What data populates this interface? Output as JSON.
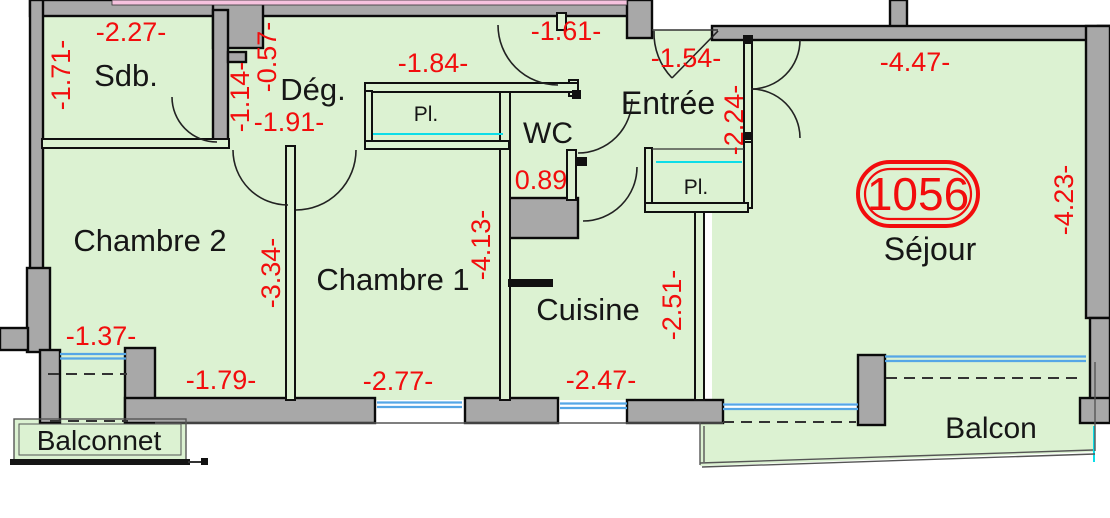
{
  "plan": {
    "unit_number": "1056",
    "rooms": [
      {
        "id": "sdb",
        "label": "Sdb."
      },
      {
        "id": "degagement",
        "label": "Dég."
      },
      {
        "id": "entree",
        "label": "Entrée"
      },
      {
        "id": "wc",
        "label": "WC"
      },
      {
        "id": "chambre2",
        "label": "Chambre 2"
      },
      {
        "id": "chambre1",
        "label": "Chambre 1"
      },
      {
        "id": "cuisine",
        "label": "Cuisine"
      },
      {
        "id": "sejour",
        "label": "Séjour"
      },
      {
        "id": "balcon",
        "label": "Balcon"
      },
      {
        "id": "balconnet",
        "label": "Balconnet"
      }
    ],
    "closets": [
      {
        "label": "Pl."
      },
      {
        "label": "Pl."
      }
    ],
    "dims_h": [
      {
        "label": "-2.27-"
      },
      {
        "label": "-1.84-"
      },
      {
        "label": "-1.61-"
      },
      {
        "label": "-1.54-"
      },
      {
        "label": "-4.47-"
      },
      {
        "label": "-1.91-"
      },
      {
        "label": "0.89"
      },
      {
        "label": "-1.37-"
      },
      {
        "label": "-1.79-"
      },
      {
        "label": "-2.77-"
      },
      {
        "label": "-2.47-"
      }
    ],
    "dims_v": [
      {
        "label": "-1.71-"
      },
      {
        "label": "-0.57-"
      },
      {
        "label": "-1.14-"
      },
      {
        "label": "-2.24-"
      },
      {
        "label": "-4.23-"
      },
      {
        "label": "-3.34-"
      },
      {
        "label": "-4.13-"
      },
      {
        "label": "-2.51-"
      }
    ],
    "colors": {
      "room_fill": "#dcf2d2",
      "wall_fill": "#a8a8a8",
      "wall_stroke": "#0a0a0a",
      "dimension_red": "#f20d0d",
      "window_blue": "#55a6e6",
      "closet_rail_cyan": "#0cdde8",
      "neighbor_pink": "#f6c3de"
    }
  }
}
